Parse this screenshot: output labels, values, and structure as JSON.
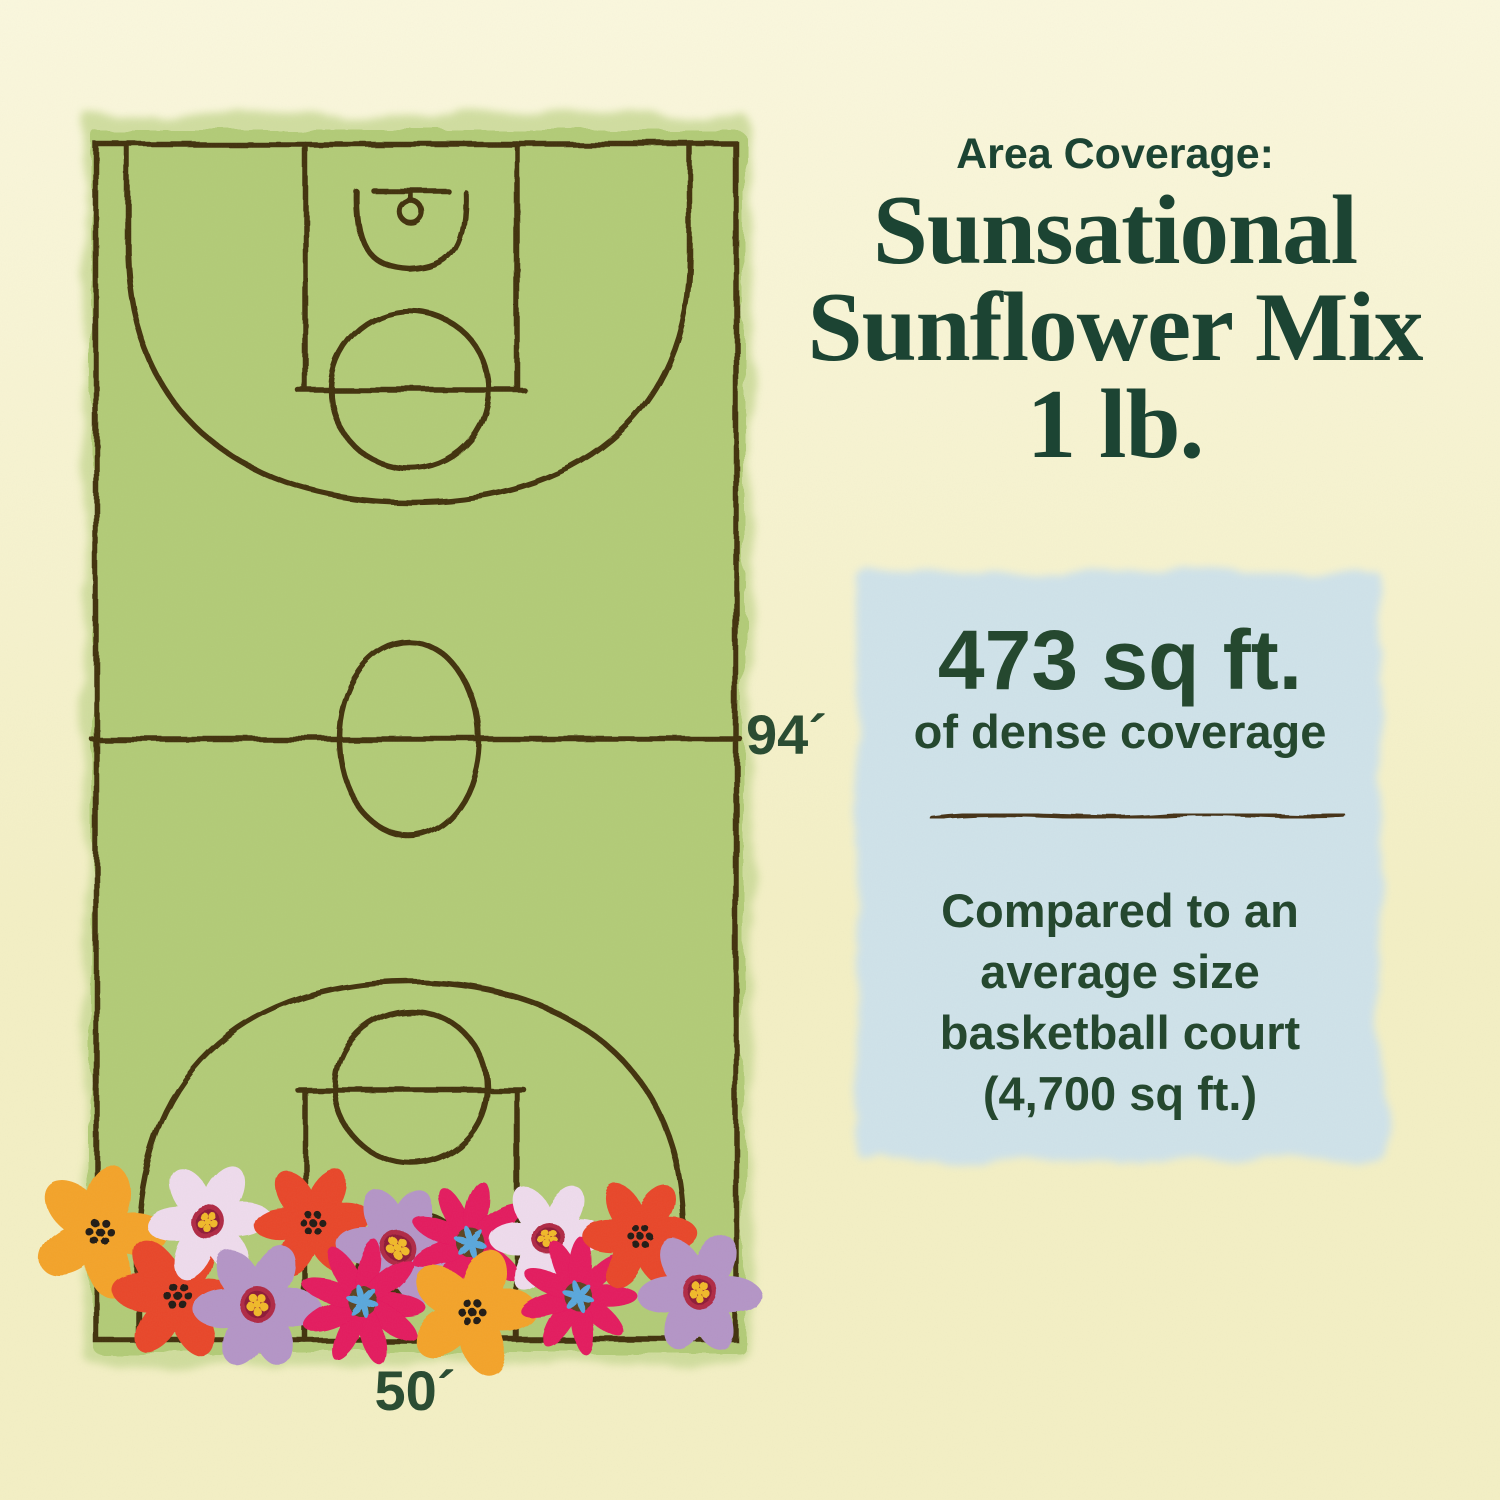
{
  "header": {
    "kicker": "Area Coverage:",
    "title_lines": [
      "Sunsational",
      "Sunflower Mix",
      "1 lb."
    ]
  },
  "coverage": {
    "value": "473 sq ft.",
    "subtitle": "of dense coverage",
    "comparison_lines": [
      "Compared to an",
      "average size",
      "basketball court",
      "(4,700 sq ft.)"
    ]
  },
  "court": {
    "length_label": "94´",
    "width_label": "50´"
  },
  "colors": {
    "background_top": "#faf7dd",
    "background_bottom": "#f3efc4",
    "court_green": "#b2cb77",
    "court_green_halo": "#c9d996",
    "line_brown": "#42300e",
    "heading_green": "#1c4433",
    "text_green": "#25482f",
    "dim_green": "#2b4d33",
    "coverage_panel_blue": "#cfe2e9",
    "divider_brown": "#443319",
    "flower_orange": "#f3a32c",
    "flower_red": "#e8472b",
    "flower_pink": "#eedbec",
    "flower_lavender": "#b495c6",
    "flower_magenta": "#e31a5e",
    "flower_center_black": "#221a12",
    "flower_center_ring": "#b02a45",
    "flower_center_ring_inner": "#8e1f38",
    "flower_center_yellow": "#f0b929",
    "flower_center_star_bg": "#5c4420",
    "flower_center_blue": "#5aa7db"
  },
  "illustration": {
    "flowers": [
      {
        "type": "poppy_orange",
        "x": 100,
        "y": 1232,
        "r": 62
      },
      {
        "type": "poppy_red",
        "x": 178,
        "y": 1296,
        "r": 62
      },
      {
        "type": "daisy_pink",
        "x": 208,
        "y": 1222,
        "r": 58
      },
      {
        "type": "poppy_red",
        "x": 312,
        "y": 1222,
        "r": 55
      },
      {
        "type": "daisy_lavender",
        "x": 258,
        "y": 1305,
        "r": 60
      },
      {
        "type": "daisy_lavender",
        "x": 398,
        "y": 1248,
        "r": 58
      },
      {
        "type": "cosmos_magenta",
        "x": 363,
        "y": 1302,
        "r": 58
      },
      {
        "type": "cosmos_magenta",
        "x": 470,
        "y": 1242,
        "r": 56
      },
      {
        "type": "daisy_pink",
        "x": 548,
        "y": 1238,
        "r": 55
      },
      {
        "type": "poppy_orange",
        "x": 472,
        "y": 1312,
        "r": 60
      },
      {
        "type": "cosmos_magenta",
        "x": 578,
        "y": 1296,
        "r": 54
      },
      {
        "type": "poppy_red",
        "x": 640,
        "y": 1236,
        "r": 54
      },
      {
        "type": "daisy_lavender",
        "x": 700,
        "y": 1292,
        "r": 58
      }
    ]
  }
}
